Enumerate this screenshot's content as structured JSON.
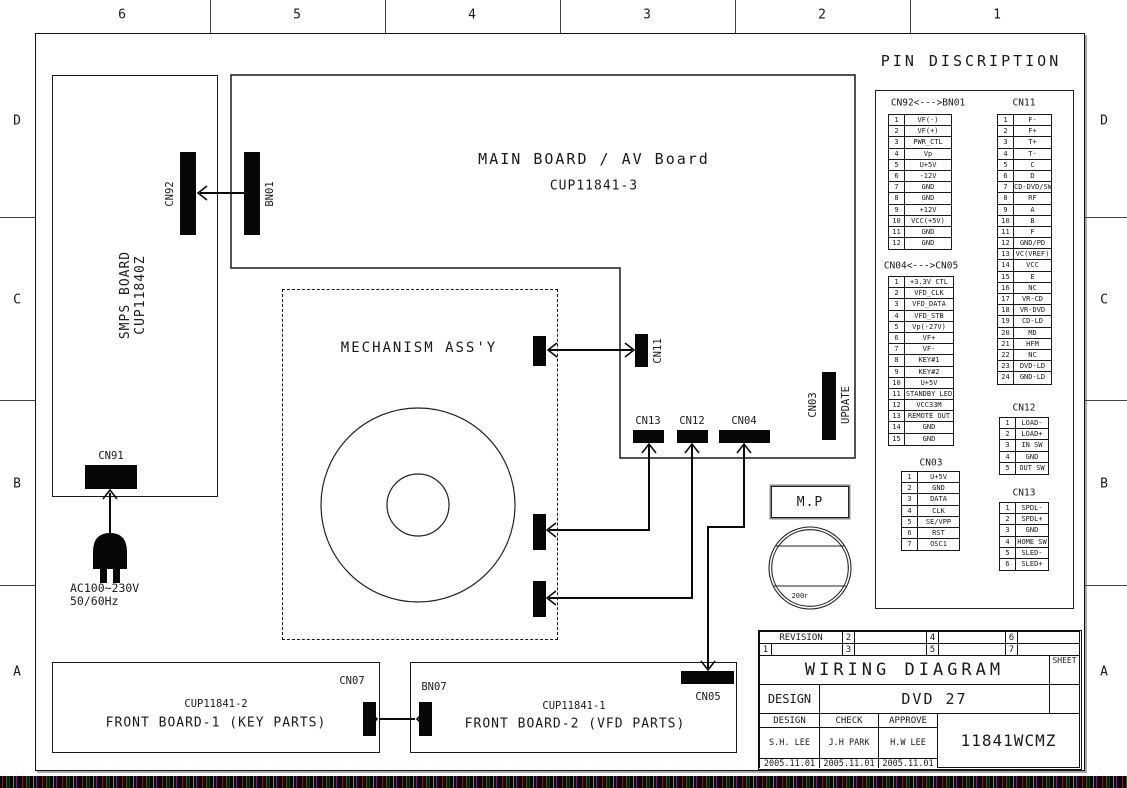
{
  "grid": {
    "columns": [
      "6",
      "5",
      "4",
      "3",
      "2",
      "1"
    ],
    "rows": [
      "D",
      "C",
      "B",
      "A"
    ]
  },
  "boards": {
    "smps": {
      "name": "SMPS BOARD",
      "code": "CUP11840Z"
    },
    "main": {
      "name": "MAIN BOARD / AV Board",
      "code": "CUP11841-3"
    },
    "mechanism": {
      "name": "MECHANISM ASS'Y"
    },
    "front1": {
      "code": "CUP11841-2",
      "name": "FRONT BOARD-1 (KEY PARTS)"
    },
    "front2": {
      "code": "CUP11841-1",
      "name": "FRONT BOARD-2 (VFD PARTS)"
    }
  },
  "connectors": {
    "cn92": "CN92",
    "bn01": "BN01",
    "cn91": "CN91",
    "cn11": "CN11",
    "cn13": "CN13",
    "cn12": "CN12",
    "cn04": "CN04",
    "cn03": "CN03",
    "cn03_update": "UPDATE",
    "cn05": "CN05",
    "cn07": "CN07",
    "bn07": "BN07"
  },
  "power_input": {
    "voltage": "AC100~230V",
    "frequency": "50/60Hz"
  },
  "mp_stamp": {
    "label": "M.P",
    "year_text": "200г"
  },
  "pin_description": {
    "title": "PIN DISCRIPTION",
    "tables": {
      "cn92_bn01": {
        "title": "CN92<--->BN01",
        "pins": [
          [
            "1",
            "VF(-)"
          ],
          [
            "2",
            "VF(+)"
          ],
          [
            "3",
            "PWR_CTL"
          ],
          [
            "4",
            "Vp"
          ],
          [
            "5",
            "U+5V"
          ],
          [
            "6",
            "-12V"
          ],
          [
            "7",
            "GND"
          ],
          [
            "8",
            "GND"
          ],
          [
            "9",
            "+12V"
          ],
          [
            "10",
            "VCC(+5V)"
          ],
          [
            "11",
            "GND"
          ],
          [
            "12",
            "GND"
          ]
        ]
      },
      "cn11": {
        "title": "CN11",
        "pins": [
          [
            "1",
            "F-"
          ],
          [
            "2",
            "F+"
          ],
          [
            "3",
            "T+"
          ],
          [
            "4",
            "T-"
          ],
          [
            "5",
            "C"
          ],
          [
            "6",
            "D"
          ],
          [
            "7",
            "CD-DVD/SW"
          ],
          [
            "8",
            "RF"
          ],
          [
            "9",
            "A"
          ],
          [
            "10",
            "B"
          ],
          [
            "11",
            "F"
          ],
          [
            "12",
            "GND/PD"
          ],
          [
            "13",
            "VC(VREF)"
          ],
          [
            "14",
            "VCC"
          ],
          [
            "15",
            "E"
          ],
          [
            "16",
            "NC"
          ],
          [
            "17",
            "VR-CD"
          ],
          [
            "18",
            "VR-DVD"
          ],
          [
            "19",
            "CD-LD"
          ],
          [
            "20",
            "MD"
          ],
          [
            "21",
            "HFM"
          ],
          [
            "22",
            "NC"
          ],
          [
            "23",
            "DVD-LD"
          ],
          [
            "24",
            "GND-LD"
          ]
        ]
      },
      "cn04_cn05": {
        "title": "CN04<--->CN05",
        "pins": [
          [
            "1",
            "+3.3V CTL"
          ],
          [
            "2",
            "VFD_CLK"
          ],
          [
            "3",
            "VFD_DATA"
          ],
          [
            "4",
            "VFD_STB"
          ],
          [
            "5",
            "Vp(-27V)"
          ],
          [
            "6",
            "VF+"
          ],
          [
            "7",
            "VF-"
          ],
          [
            "8",
            "KEY#1"
          ],
          [
            "9",
            "KEY#2"
          ],
          [
            "10",
            "U+5V"
          ],
          [
            "11",
            "STANDBY LED"
          ],
          [
            "12",
            "VCC33M"
          ],
          [
            "13",
            "REMOTE OUT"
          ],
          [
            "14",
            "GND"
          ],
          [
            "15",
            "GND"
          ]
        ]
      },
      "cn12": {
        "title": "CN12",
        "pins": [
          [
            "1",
            "LOAD-"
          ],
          [
            "2",
            "LOAD+"
          ],
          [
            "3",
            "IN SW"
          ],
          [
            "4",
            "GND"
          ],
          [
            "5",
            "OUT SW"
          ]
        ]
      },
      "cn03": {
        "title": "CN03",
        "pins": [
          [
            "1",
            "U+5V"
          ],
          [
            "2",
            "GND"
          ],
          [
            "3",
            "DATA"
          ],
          [
            "4",
            "CLK"
          ],
          [
            "5",
            "SE/VPP"
          ],
          [
            "6",
            "RST"
          ],
          [
            "7",
            "OSC1"
          ]
        ]
      },
      "cn13": {
        "title": "CN13",
        "pins": [
          [
            "1",
            "SPDL-"
          ],
          [
            "2",
            "SPDL+"
          ],
          [
            "3",
            "GND"
          ],
          [
            "4",
            "HOME SW"
          ],
          [
            "5",
            "SLED-"
          ],
          [
            "6",
            "SLED+"
          ]
        ]
      }
    }
  },
  "title_block": {
    "revision_label": "REVISION",
    "revision_slots": [
      "1",
      "2",
      "3",
      "4",
      "5",
      "6",
      "7"
    ],
    "sheet_label": "SHEET",
    "doc_title": "WIRING DIAGRAM",
    "design_row_label": "DESIGN",
    "model": "DVD 27",
    "approval_columns": [
      "DESIGN",
      "CHECK",
      "APPROVE"
    ],
    "approval_names": [
      "S.H. LEE",
      "J.H PARK",
      "H.W LEE"
    ],
    "approval_dates": [
      "2005.11.01",
      "2005.11.01",
      "2005.11.01"
    ],
    "drawing_number": "11841WCMZ"
  }
}
